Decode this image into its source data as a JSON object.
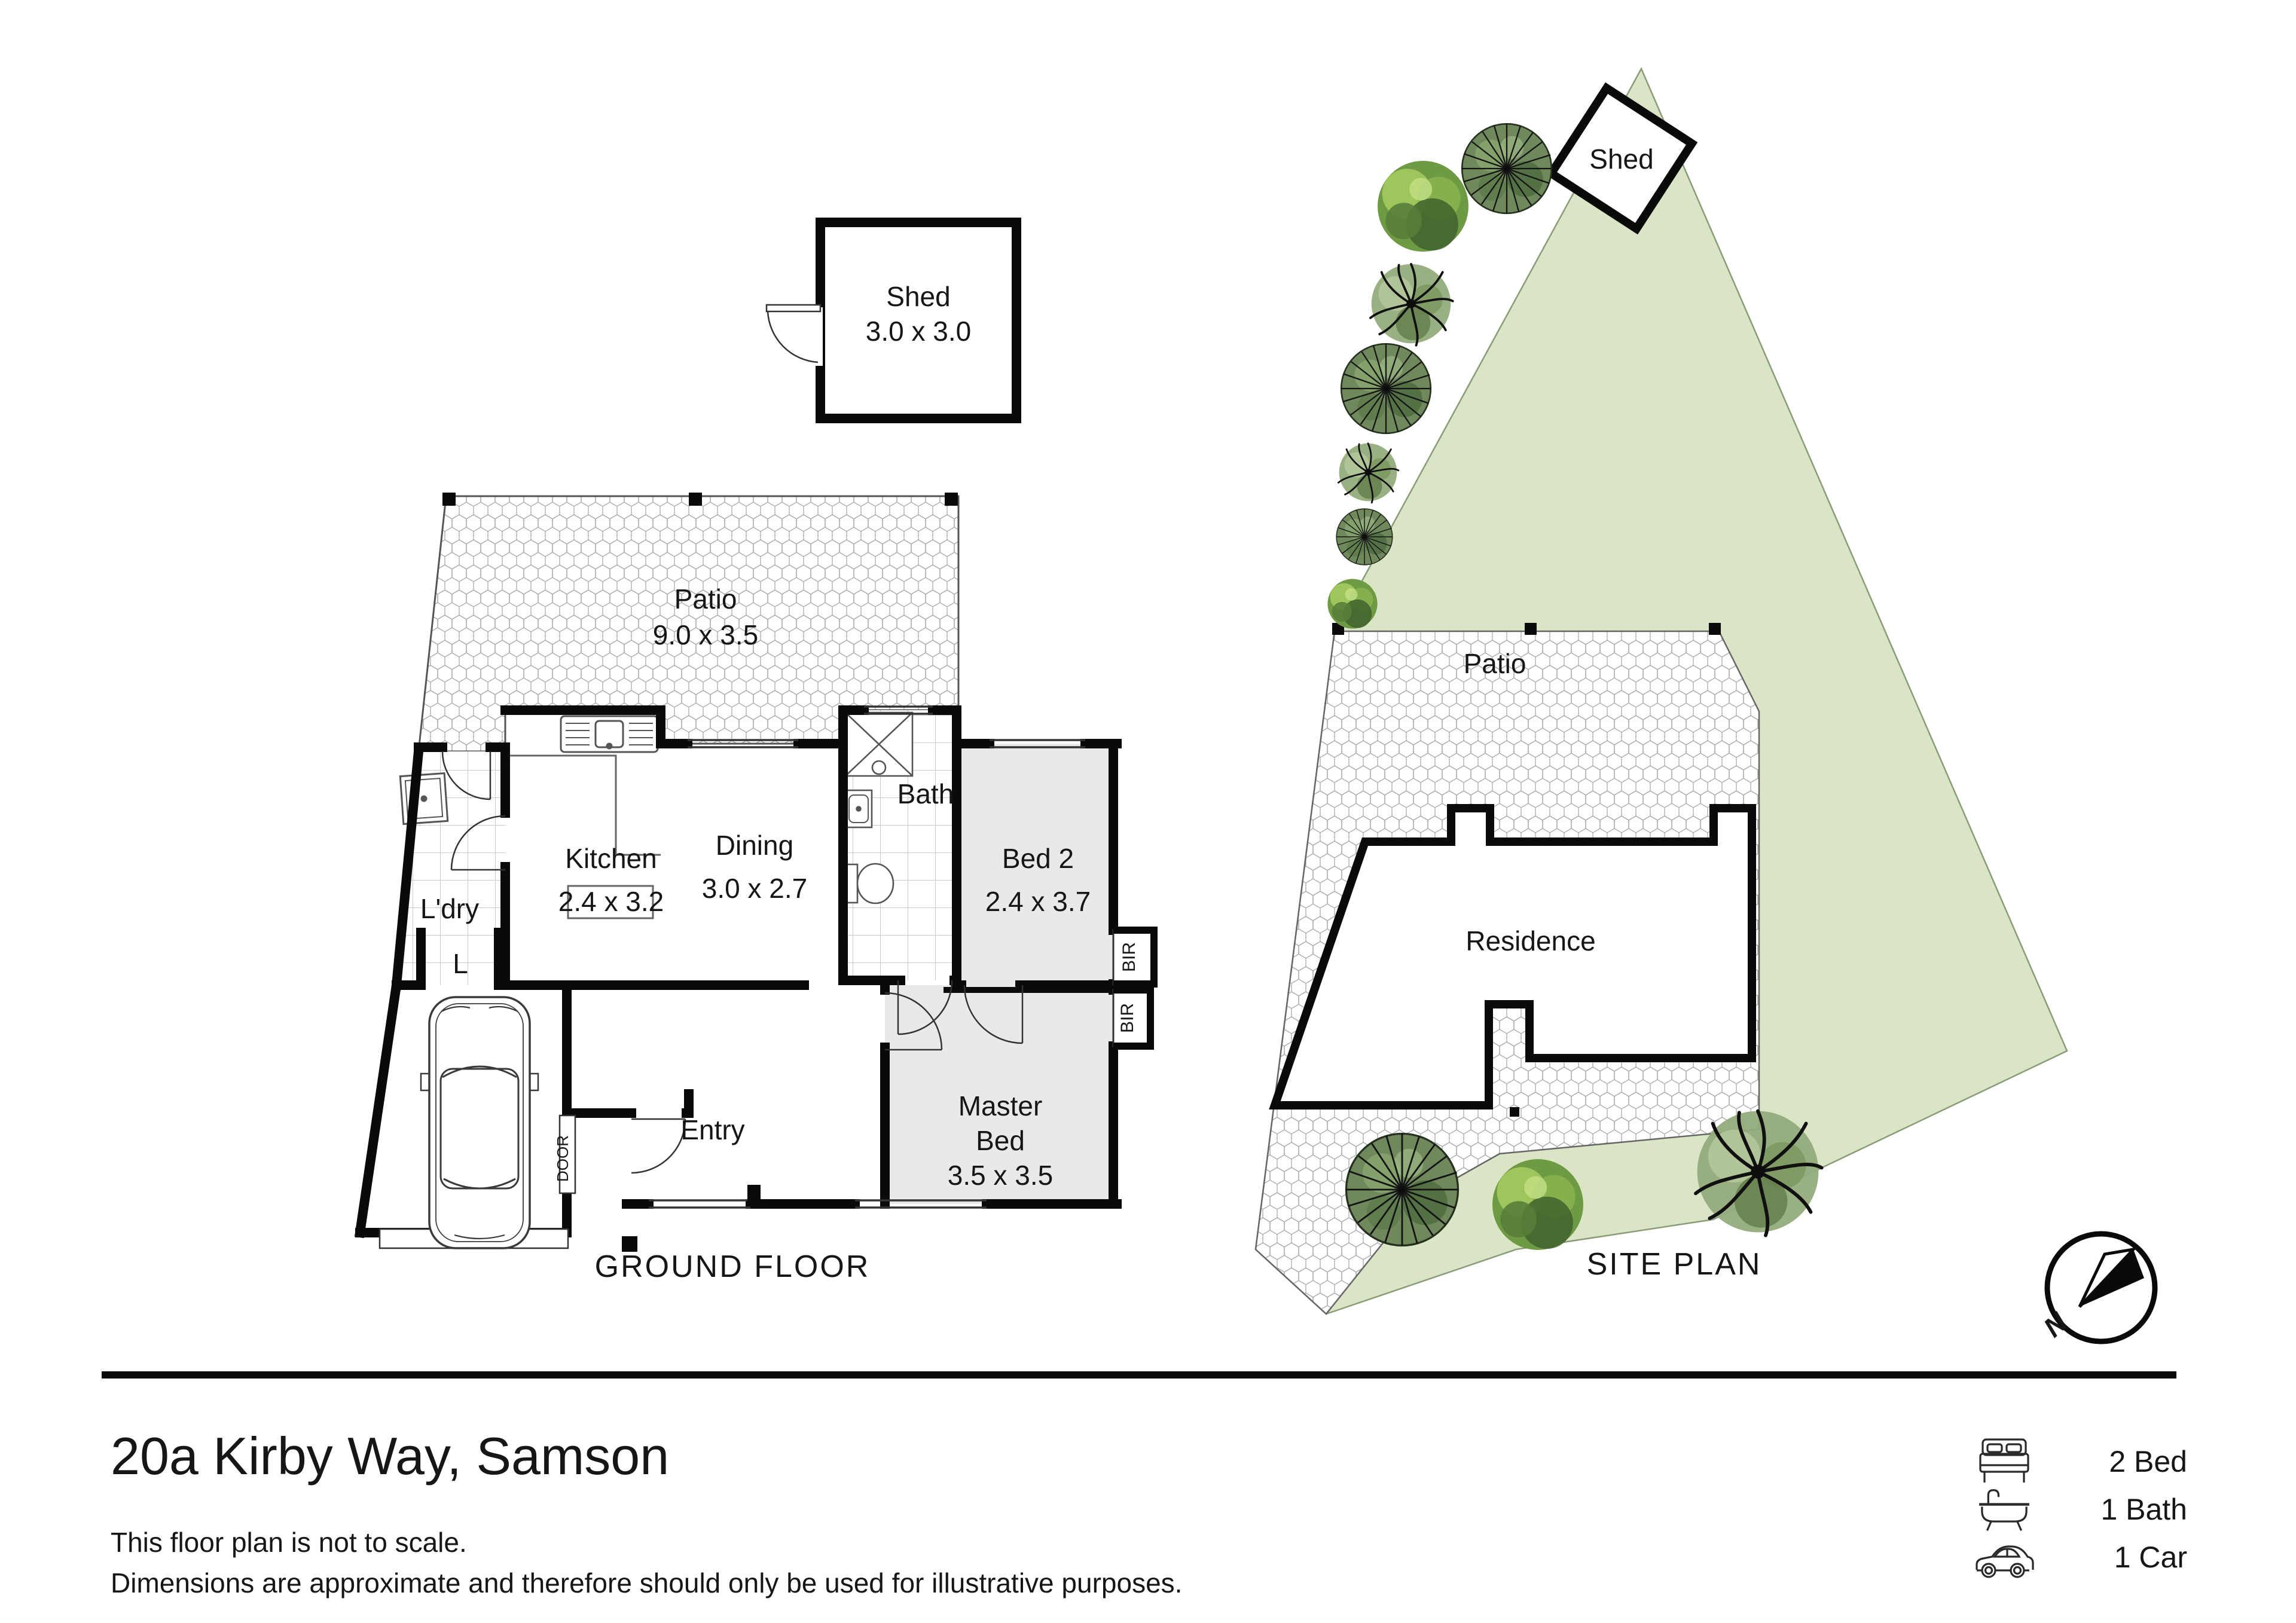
{
  "colors": {
    "lot_green": "#d9e5c4",
    "room_gray": "#e9e9e9",
    "wall_black": "#0a0a0a",
    "hatch_line": "#adadad",
    "tile_line": "#c9c9c9"
  },
  "ground_floor": {
    "title": "GROUND FLOOR",
    "shed_name": "Shed",
    "shed_dims": "3.0 x 3.0",
    "patio_name": "Patio",
    "patio_dims": "9.0 x 3.5",
    "kitchen_name": "Kitchen",
    "kitchen_dims": "2.4 x 3.2",
    "dining_name": "Dining",
    "dining_dims": "3.0 x 2.7",
    "bath_name": "Bath",
    "laundry_name": "L'dry",
    "linen_label": "L",
    "bed2_name": "Bed 2",
    "bed2_dims": "2.4 x 3.7",
    "master_line1": "Master",
    "master_line2": "Bed",
    "master_dims": "3.5 x 3.5",
    "entry_name": "Entry",
    "bir_label": "BIR",
    "door_label": "DOOR"
  },
  "site_plan": {
    "title": "SITE PLAN",
    "shed_label": "Shed",
    "patio_label": "Patio",
    "residence_label": "Residence",
    "north_label": "N"
  },
  "footer": {
    "address": "20a Kirby Way, Samson",
    "disclaimer_line1": "This floor plan is not to scale.",
    "disclaimer_line2": "Dimensions are approximate and therefore should only be used for illustrative purposes.",
    "features": [
      {
        "icon": "bed-icon",
        "label": "2 Bed"
      },
      {
        "icon": "bath-icon",
        "label": "1 Bath"
      },
      {
        "icon": "car-icon",
        "label": "1 Car"
      }
    ]
  }
}
